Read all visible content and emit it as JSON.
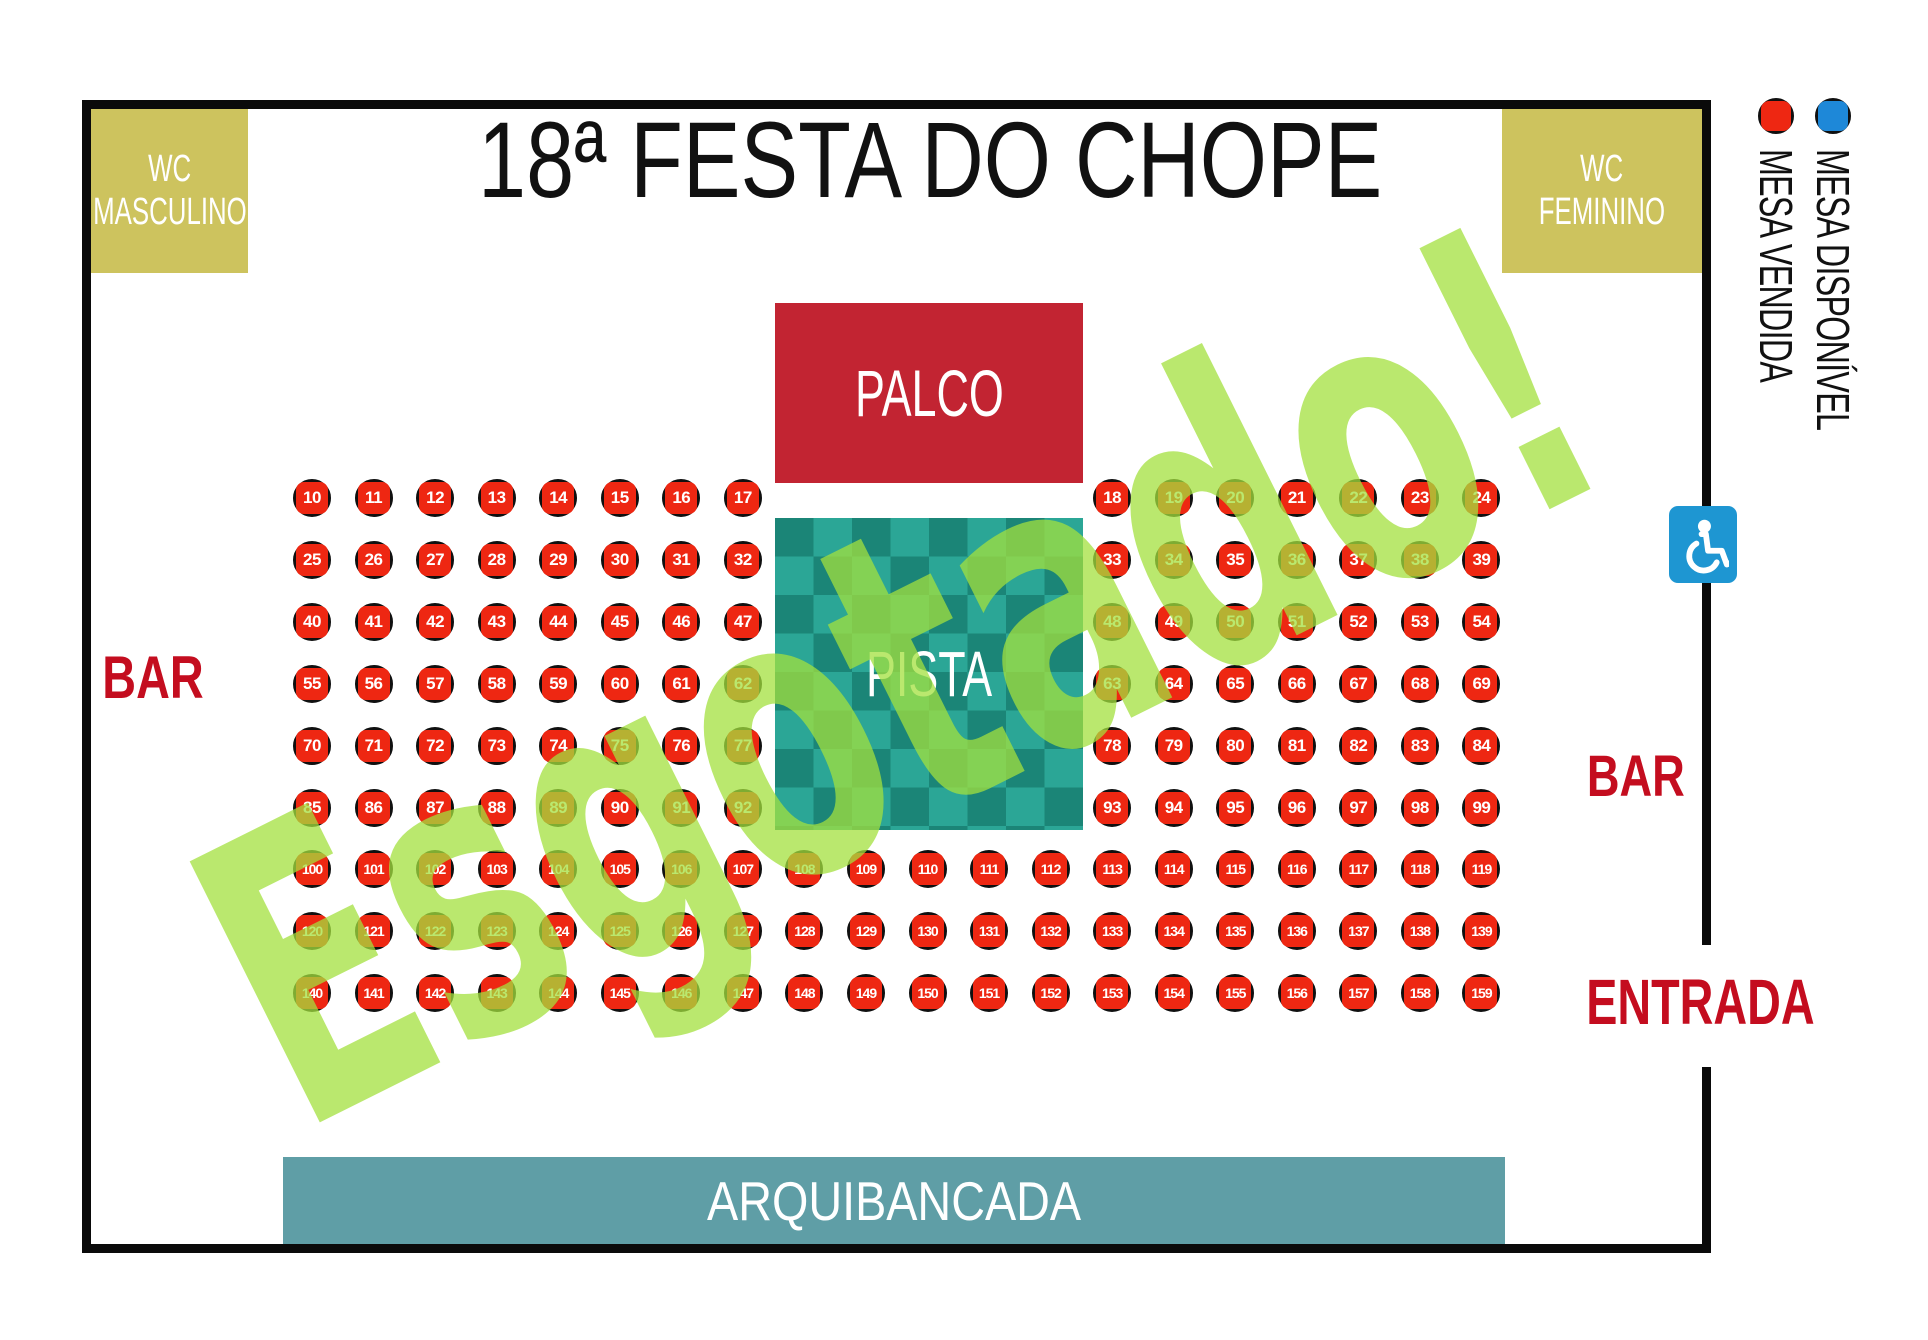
{
  "title": "18ª FESTA DO CHOPE",
  "watermark": "Esgotado!",
  "areas": {
    "wc_left": {
      "line1": "WC",
      "line2": "MASCULINO"
    },
    "wc_right": {
      "line1": "WC",
      "line2": "FEMININO"
    },
    "palco": "PALCO",
    "pista": "PISTA",
    "arquibancada": "ARQUIBANCADA",
    "bar_left": "BAR",
    "bar_right": "BAR",
    "entrada": "ENTRADA"
  },
  "legend": [
    {
      "label": "MESA VENDIDA",
      "status": "vendida",
      "color": "#ee2712"
    },
    {
      "label": "MESA DISPONÍVEL",
      "status": "disponivel",
      "color": "#1e88d8"
    }
  ],
  "colors": {
    "table_sold": "#ee2712",
    "table_available": "#1e88d8",
    "khaki_wc": "#cdc35e",
    "palco_red": "#c22432",
    "bar_text_red": "#c40d1f",
    "stand_teal": "#5f9ea6",
    "checker_dark": "#1b8577",
    "checker_light": "#2ba696",
    "wheelchair_blue": "#1e96d2",
    "watermark_green": "rgba(163,224,61,0.75)"
  },
  "seating": {
    "all_tables_status": "vendida",
    "rows": [
      {
        "left": [
          10,
          11,
          12,
          13,
          14,
          15,
          16,
          17
        ],
        "right": [
          18,
          19,
          20,
          21,
          22,
          23,
          24
        ]
      },
      {
        "left": [
          25,
          26,
          27,
          28,
          29,
          30,
          31,
          32
        ],
        "right": [
          33,
          34,
          35,
          36,
          37,
          38,
          39
        ]
      },
      {
        "left": [
          40,
          41,
          42,
          43,
          44,
          45,
          46,
          47
        ],
        "right": [
          48,
          49,
          50,
          51,
          52,
          53,
          54
        ]
      },
      {
        "left": [
          55,
          56,
          57,
          58,
          59,
          60,
          61,
          62
        ],
        "right": [
          63,
          64,
          65,
          66,
          67,
          68,
          69
        ]
      },
      {
        "left": [
          70,
          71,
          72,
          73,
          74,
          75,
          76,
          77
        ],
        "right": [
          78,
          79,
          80,
          81,
          82,
          83,
          84
        ]
      },
      {
        "left": [
          85,
          86,
          87,
          88,
          89,
          90,
          91,
          92
        ],
        "right": [
          93,
          94,
          95,
          96,
          97,
          98,
          99
        ]
      },
      {
        "full": [
          100,
          101,
          102,
          103,
          104,
          105,
          106,
          107,
          108,
          109,
          110,
          111,
          112,
          113,
          114,
          115,
          116,
          117,
          118,
          119
        ]
      },
      {
        "full": [
          120,
          121,
          122,
          123,
          124,
          125,
          126,
          127,
          128,
          129,
          130,
          131,
          132,
          133,
          134,
          135,
          136,
          137,
          138,
          139
        ]
      },
      {
        "full": [
          140,
          141,
          142,
          143,
          144,
          145,
          146,
          147,
          148,
          149,
          150,
          151,
          152,
          153,
          154,
          155,
          156,
          157,
          158,
          159
        ]
      }
    ]
  }
}
